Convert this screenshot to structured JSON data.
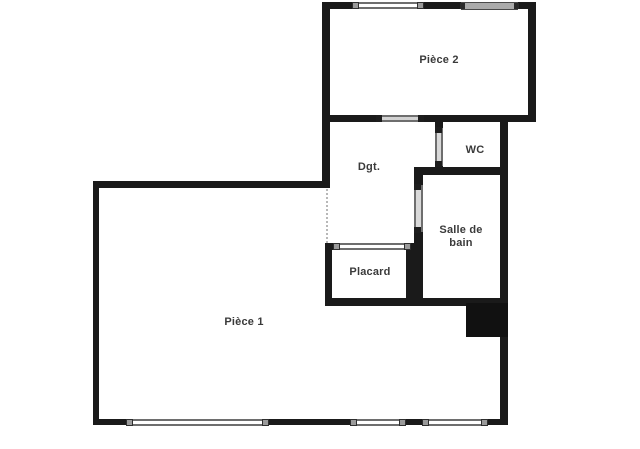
{
  "plan": {
    "title": "Apartment floor plan",
    "rooms": [
      {
        "name": "piece-2",
        "label": "Pièce 2"
      },
      {
        "name": "wc",
        "label": "WC"
      },
      {
        "name": "degagement",
        "label": "Dgt."
      },
      {
        "name": "salle-de-bain",
        "label": "Salle de bain"
      },
      {
        "name": "placard",
        "label": "Placard"
      },
      {
        "name": "piece-1",
        "label": "Pièce 1"
      }
    ],
    "colors": {
      "wall": "#1a1a1a",
      "window_frame": "#6e6e6e",
      "window_fill": "#ffffff",
      "glazing": "#ababab",
      "door_leaf": "#d6d6d6",
      "label_text": "#3a3a3a",
      "background": "#ffffff"
    }
  }
}
